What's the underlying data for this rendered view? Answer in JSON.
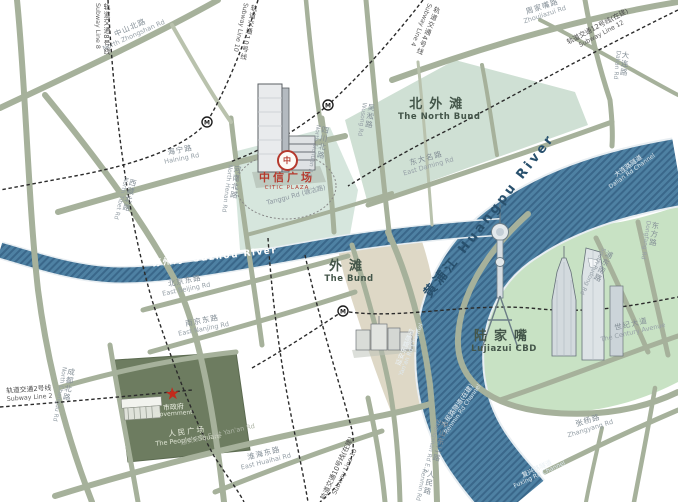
{
  "colors": {
    "river": "#4e81a3",
    "river_hatch": "#3a678a",
    "road": "#a6b19b",
    "north_bund_area": "#cfe0d4",
    "citic_area": "#d6e6dd",
    "bund_area": "#ded8c6",
    "lujiazui_area": "#c8e2c4",
    "peoples_square_area": "#6d7c60",
    "citic_red": "#b5392d",
    "star_red": "#c22a1c",
    "metro_line": "#2b2b2b"
  },
  "areas": {
    "north_bund": {
      "zh": "北外滩",
      "en": "The North Bund"
    },
    "bund": {
      "zh": "外滩",
      "en": "The Bund"
    },
    "lujiazui": {
      "zh": "陆家嘴",
      "en": "Lujiazui CBD"
    },
    "peoples_square": {
      "zh": "人民广场",
      "en": "The People's Square"
    }
  },
  "landmarks": {
    "citic": {
      "zh": "中信广场",
      "en": "CITIC PLAZA",
      "logo_glyph": "中"
    },
    "government": {
      "zh": "市政府",
      "en": "Government",
      "star": "★"
    }
  },
  "rivers": {
    "suzhou": {
      "zh": "苏州河",
      "en": "Suzhou River"
    },
    "huangpu": {
      "zh": "黄浦江",
      "en": "Huangpu River",
      "display": "黄浦江  Huangpu River"
    },
    "dalian_channel": {
      "zh": "大连路隧道",
      "en": "Dalian Rd Channel"
    },
    "yanan_channel": {
      "zh": "延安东路隧道",
      "en": "Yan'an Rd Channel"
    },
    "renmin_channel": {
      "zh": "人民路隧道(在建)",
      "en": "Renmin Rd Channel"
    },
    "fuxing_channel": {
      "zh": "复兴路隧道",
      "en": "Fuxing Rd Channel"
    }
  },
  "subway": {
    "line2": {
      "zh": "轨道交通2号线",
      "en": "Subway Line 2"
    },
    "line4": {
      "zh": "轨道交通4号线",
      "en": "Subway Line 4"
    },
    "line8": {
      "zh": "轨道交通8号线",
      "en": "Subway Line 8"
    },
    "line10_north": {
      "zh": "轨道交通10号线",
      "en": "Subway Line 10"
    },
    "line10_south": {
      "zh": "轨道交通10号线(在建)",
      "en": "Subway Line 10"
    },
    "line12": {
      "zh": "轨道交通12号线(在建)",
      "en": "Subway Line 12"
    }
  },
  "roads": {
    "zhongshan_n": {
      "zh": "中山北路",
      "en": "North Zhongshan Rd"
    },
    "haining": {
      "zh": "海宁路",
      "en": "Haining Rd"
    },
    "henan_n": {
      "zh": "河南北路",
      "en": "North Henan Rd"
    },
    "sichuan_n": {
      "zh": "四川北路",
      "en": "North Sichuan Rd"
    },
    "wusong": {
      "zh": "吴淞路",
      "en": "Wusong Rd"
    },
    "zhoujiazui": {
      "zh": "周家嘴路",
      "en": "Zhoujiazui Rd"
    },
    "dalian": {
      "zh": "大连路",
      "en": "Dalian Rd"
    },
    "daming_e": {
      "zh": "东大名路",
      "en": "East Daming Rd"
    },
    "tanggu": {
      "display": "Tanggu Rd (塘沽路)"
    },
    "tibet_n": {
      "zh": "西藏北路",
      "en": "North Tibet Rd"
    },
    "beijing_e": {
      "zh": "北京东路",
      "en": "East Beijing Rd"
    },
    "nanjing_e": {
      "zh": "南京东路",
      "en": "East Nanjing Rd"
    },
    "chengdu_n": {
      "zh": "成都北路",
      "en": "North Chengdu Rd"
    },
    "yanan_e": {
      "display": "延安东路  East Yan'an Rd"
    },
    "huaihai_e": {
      "zh": "淮海东路",
      "en": "East Huaihai Rd"
    },
    "renmin": {
      "zh": "人民路",
      "en": "Renmin Rd"
    },
    "zhongshan_e2": {
      "zh": "中山东二路",
      "en": "Zhongshan Rd E.2"
    },
    "century": {
      "zh": "世纪大道",
      "en": "The Century Avenue"
    },
    "dongfang": {
      "zh": "东方路",
      "en": "Dongfang Rd"
    },
    "pudong_s": {
      "zh": "浦东南路",
      "en": "South Pudong Rd"
    },
    "zhangyang": {
      "zh": "张杨路",
      "en": "Zhangyang Rd"
    }
  }
}
